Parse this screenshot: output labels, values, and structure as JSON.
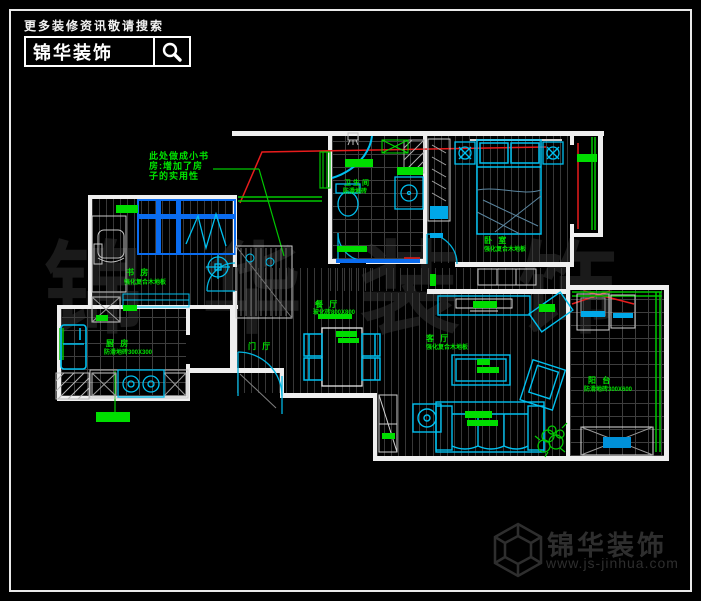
{
  "header": {
    "tagline": "更多装修资讯敬请搜索",
    "brand": "锦华装饰"
  },
  "footer": {
    "brand": "锦华装饰",
    "website": "www.js-jinhua.com"
  },
  "watermark": "锦华装饰",
  "annotation_note": {
    "line1": "此处做成小书",
    "line2": "房:增加了房",
    "line3": "子的实用性"
  },
  "rooms": {
    "study": {
      "name": "书 房",
      "finish": "强化复合木地板"
    },
    "bathroom": {
      "name": "卫生间",
      "finish": "防滑地砖"
    },
    "bedroom": {
      "name": "卧 室",
      "finish": "强化复合木地板"
    },
    "dining": {
      "name": "餐 厅",
      "finish": "玻化砖800X800"
    },
    "entry": {
      "name": "门 厅"
    },
    "living": {
      "name": "客 厅",
      "finish": "强化复合木地板"
    },
    "kitchen": {
      "name": "厨 房",
      "finish": "防滑地砖300X300"
    },
    "balcony": {
      "name": "阳 台",
      "finish": "防滑地砖300X600"
    }
  },
  "colors": {
    "wall": "#efefef",
    "furniture_cyan": "#00c0f0",
    "accent_blue": "#0a6cf0",
    "label_green": "#00e400",
    "annotation_red": "#e81c1c",
    "watermark_gray": "#1a1a1a",
    "footer_gray": "#2e2e2e"
  }
}
